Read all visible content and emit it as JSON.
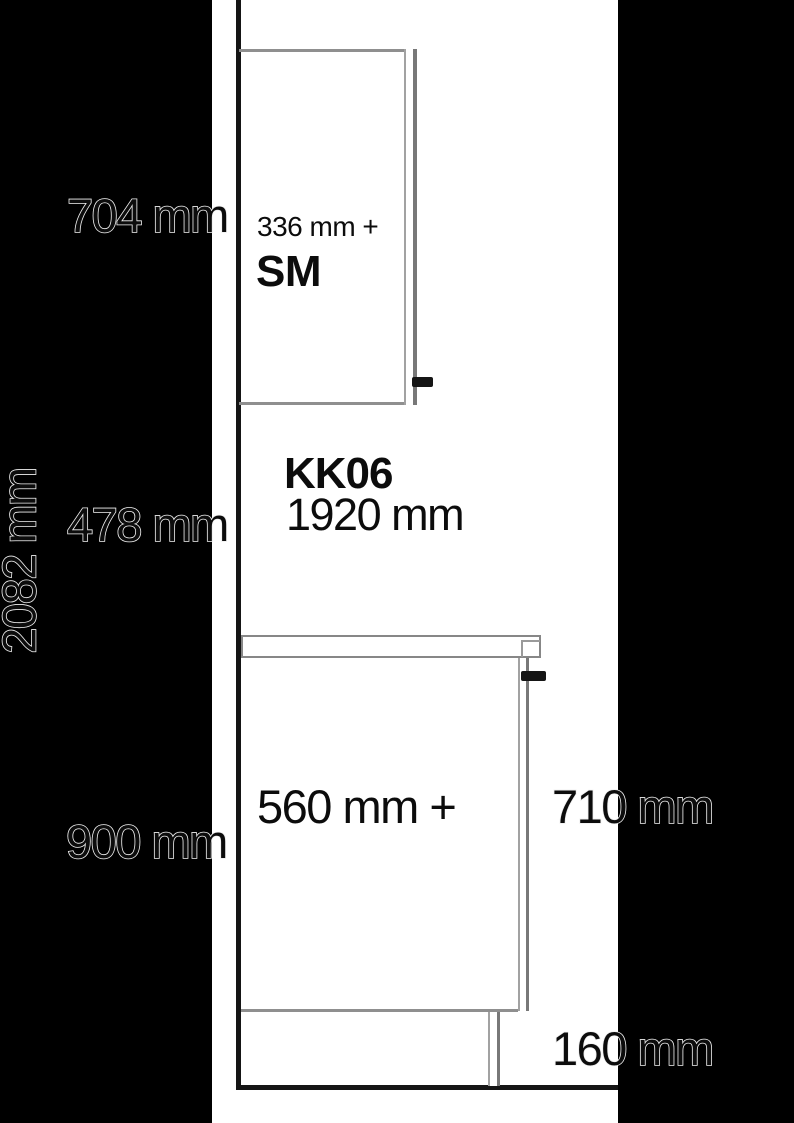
{
  "diagram": {
    "wall_cabinet_height": "704 mm",
    "wall_cabinet_depth": "336 mm +",
    "wall_cabinet_depth_suffix": "SM",
    "mounting_code": "KK06",
    "mounting_height": "1920 mm",
    "splashback_height": "478 mm",
    "total_height": "2082 mm",
    "base_depth": "560 mm +",
    "base_height": "710 mm",
    "worktop_height": "900 mm",
    "plinth_height": "160 mm"
  },
  "colors": {
    "background": "#ffffff",
    "side_bands": "#000000",
    "structure_dark": "#151515",
    "cabinet_gray": "#8f8f8f",
    "text": "#0c0c0c",
    "outline_stroke": "#efefef"
  }
}
